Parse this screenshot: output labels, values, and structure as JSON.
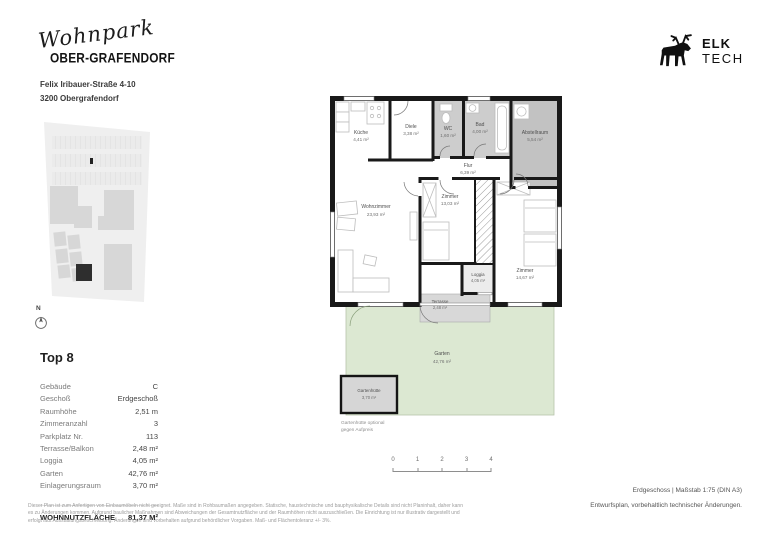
{
  "header": {
    "brand_script": "Wohnpark",
    "brand_name": "OBER-GRAFENDORF",
    "address_line1": "Felix Iribauer-Straße 4-10",
    "address_line2": "3200 Obergrafendorf"
  },
  "logo": {
    "line1": "ELK",
    "line2": "TECH"
  },
  "site_plan": {
    "compass_label": "N"
  },
  "unit": {
    "title": "Top 8",
    "details": [
      {
        "label": "Gebäude",
        "value": "C"
      },
      {
        "label": "Geschoß",
        "value": "Erdgeschoß"
      },
      {
        "label": "Raumhöhe",
        "value": "2,51 m"
      },
      {
        "label": "Zimmeranzahl",
        "value": "3"
      },
      {
        "label": "Parkplatz Nr.",
        "value": "113"
      },
      {
        "label": "Terrasse/Balkon",
        "value": "2,48 m²"
      },
      {
        "label": "Loggia",
        "value": "4,05 m²"
      },
      {
        "label": "Garten",
        "value": "42,76 m²"
      },
      {
        "label": "Einlagerungsraum",
        "value": "3,70 m²"
      }
    ],
    "total_label": "WOHNNUTZFLÄCHE",
    "total_value": "81,37 M²"
  },
  "plan": {
    "rooms": {
      "kueche": {
        "name": "Küche",
        "area": "4,41 m²"
      },
      "diele": {
        "name": "Diele",
        "area": "3,38 m²"
      },
      "wc": {
        "name": "WC",
        "area": "1,60 m²"
      },
      "bad": {
        "name": "Bad",
        "area": "4,00 m²"
      },
      "abstellraum": {
        "name": "Abstellraum",
        "area": "5,54 m²"
      },
      "flur": {
        "name": "Flur",
        "area": "6,39 m²"
      },
      "wohnzimmer": {
        "name": "Wohnzimmer",
        "area": "23,93 m²"
      },
      "zimmer1": {
        "name": "Zimmer",
        "area": "13,03 m²"
      },
      "zimmer2": {
        "name": "Zimmer",
        "area": "14,67 m²"
      },
      "loggia": {
        "name": "Loggia",
        "area": "4,05 m²"
      },
      "terrasse": {
        "name": "Terrasse",
        "area": "2,48 m²"
      },
      "garten": {
        "name": "Garten",
        "area": "42,76 m²"
      },
      "gartenhuette": {
        "name": "Gartenhütte",
        "area": "3,70 m²"
      }
    },
    "note_line1": "Gartenhütte optional",
    "note_line2": "gegen Aufpreis"
  },
  "scale_bar": {
    "ticks": [
      "0",
      "1",
      "2",
      "3",
      "4"
    ]
  },
  "footer": {
    "plan_info": "Erdgeschoss | Maßstab 1:75 (DIN A3)",
    "plan_note": "Entwurfsplan, vorbehaltlich technischer Änderungen.",
    "disclaimer": "Dieser Plan ist zum Anfertigen von Einbaumöbeln nicht geeignet. Maße sind in Rohbaumaßen angegeben. Statische, haustechnische und bauphysikalische Details sind nicht Planinhalt, daher kann es zu Änderungen kommen. Aufgrund baulicher Maßnahmen sind Abweichungen der Gesamtnutzfläche und der Raumhöhen nicht auszuschließen. Die Einrichtung ist nur illustrativ dargestellt und erfolgt laut Ausstattungsbeschreibung. Änderungen sind vorbehalten aufgrund behördlicher Vorgaben. Maß- und Flächentoleranz +/- 3%."
  },
  "colors": {
    "wall": "#191919",
    "room_gray": "#cdcdcd",
    "storage_gray": "#c2c2c2",
    "terrace_gray": "#d8d8d8",
    "garden_green": "#dce8d2"
  }
}
